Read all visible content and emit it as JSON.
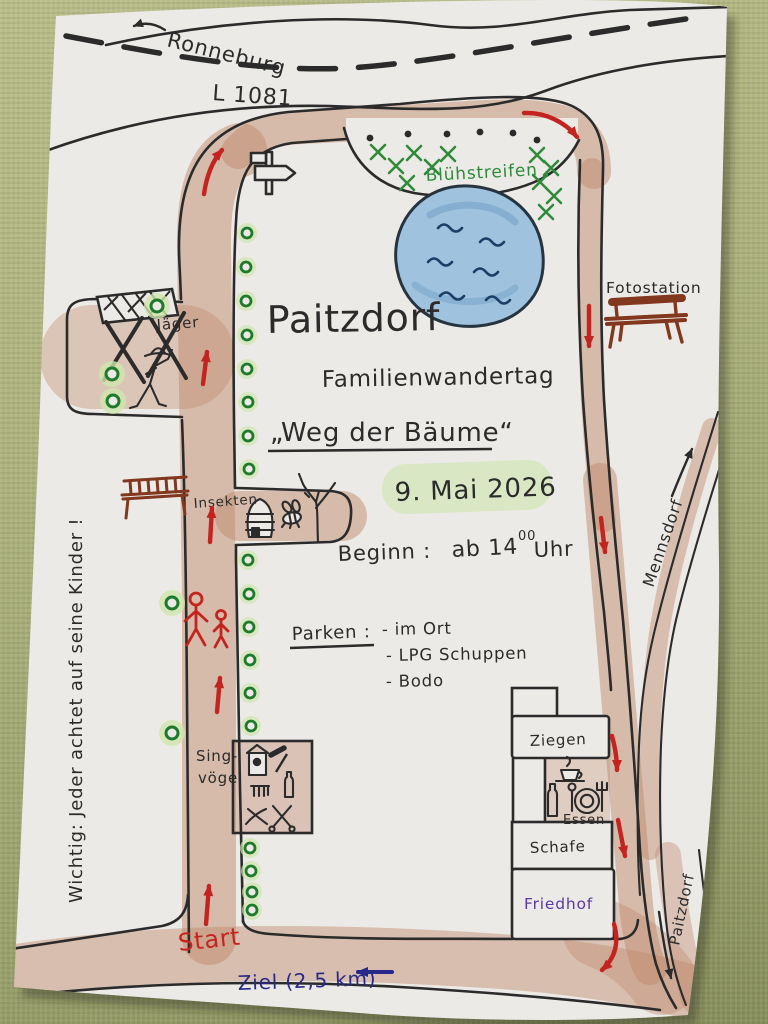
{
  "photo": {
    "description": "Hand-drawn event map on paper lying on an olive-green woven tablecloth"
  },
  "colors": {
    "fabric": "#aab076",
    "paper": "#eceae6",
    "ink": "#2b2b2b",
    "route_red": "#c42420",
    "green_text": "#2f8b3a",
    "tree_ring": "#1f7a2c",
    "tree_halo": "#cfe6ae",
    "path_brown": "#c08a6d",
    "pond_fill": "#9fc3de",
    "pond_wave": "#1d3e66",
    "purple": "#5a3aa0",
    "blue_text": "#28288a",
    "bench_red": "#82371f",
    "highlight_green": "#d8e7c0"
  },
  "labels": {
    "ronneburg": "Ronneburg",
    "road": "L 1081",
    "bluehstreifen": "Blühstreifen",
    "fotostation": "Fotostation",
    "jaeger": "Jäger",
    "insekten": "Insekten",
    "singvoegel_line1": "Sing-",
    "singvoegel_line2": "vögel",
    "mennsdorf": "Mennsdorf",
    "ziegen": "Ziegen",
    "essen": "Essen",
    "schafe": "Schafe",
    "friedhof": "Friedhof",
    "paitzdorf_road": "Paitzdorf",
    "start": "Start",
    "ziel": "Ziel (2,5 km)",
    "wichtig": "Wichtig: Jeder achtet auf seine Kinder !"
  },
  "title": {
    "town": "Paitzdorf",
    "event": "Familienwandertag",
    "route": "„Weg der Bäume“",
    "date": "9. Mai 2026",
    "begin_label": "Beginn :",
    "begin_value": "ab 14",
    "begin_sup": "00",
    "begin_unit": "Uhr"
  },
  "parken": {
    "label": "Parken :",
    "items": [
      "- im Ort",
      "- LPG Schuppen",
      "- Bodo"
    ]
  },
  "map": {
    "trees": [
      [
        247,
        233
      ],
      [
        246,
        267
      ],
      [
        246,
        301
      ],
      [
        247,
        335
      ],
      [
        247,
        369
      ],
      [
        248,
        402
      ],
      [
        248,
        436
      ],
      [
        249,
        469
      ],
      [
        248,
        560
      ],
      [
        249,
        594
      ],
      [
        249,
        627
      ],
      [
        250,
        660
      ],
      [
        250,
        693
      ],
      [
        251,
        726
      ],
      [
        250,
        848
      ],
      [
        251,
        871
      ],
      [
        252,
        892
      ],
      [
        252,
        910
      ]
    ],
    "glow_trees": [
      [
        157,
        306
      ],
      [
        112,
        374
      ],
      [
        113,
        401
      ],
      [
        172,
        603
      ],
      [
        172,
        733
      ]
    ],
    "black_dots": [
      [
        370,
        138
      ],
      [
        408,
        134
      ],
      [
        447,
        134
      ],
      [
        480,
        132
      ],
      [
        513,
        133
      ],
      [
        537,
        140
      ]
    ],
    "hatch_marks": [
      [
        378,
        152
      ],
      [
        396,
        166
      ],
      [
        414,
        153
      ],
      [
        432,
        167
      ],
      [
        448,
        154
      ],
      [
        407,
        183
      ],
      [
        537,
        155
      ],
      [
        551,
        168
      ],
      [
        540,
        182
      ],
      [
        554,
        196
      ],
      [
        546,
        212
      ]
    ],
    "route_arrows": [
      "M 204,194 Q 208,166 222,150",
      "M 524,113 C 545,112 565,122 577,137",
      "M 589,306 L 589,346",
      "M 601,518 L 605,552",
      "M 612,736 Q 617,754 617,770",
      "M 618,820 L 625,856",
      "M 614,924 Q 622,952 602,970",
      "M 203,384 L 207,352",
      "M 210,542 L 212,508",
      "M 217,712 L 220,678",
      "M 206,924 L 209,886"
    ],
    "black_arrows": [
      "M 165,30 Q 150,20 134,26",
      "M 672,496 Q 682,471 692,449",
      "M 659,912 Q 664,948 671,978"
    ],
    "blue_arrows": [
      "M 392,972 L 358,972"
    ]
  }
}
